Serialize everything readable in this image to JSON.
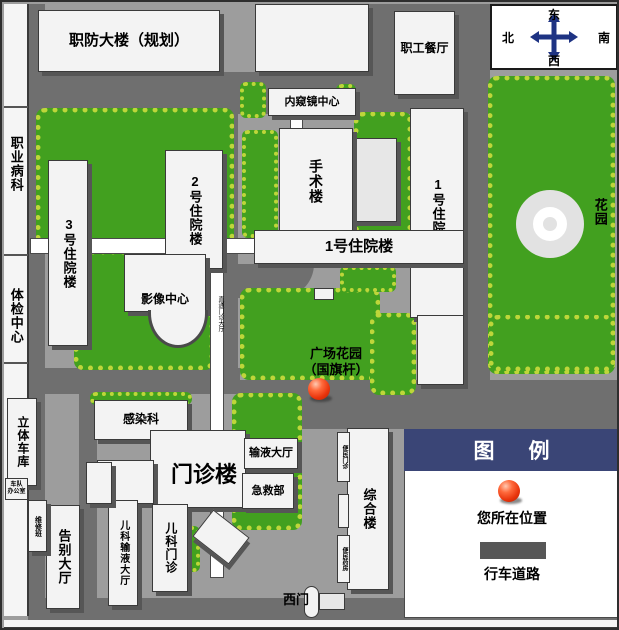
{
  "b": {
    "zhifang": "职防大楼（规划）",
    "canting": "职工餐厅",
    "neikuijing": "内窥镜中心",
    "shoushu": "手术楼",
    "zhuyuan1_tower": "1号住院楼",
    "zhuyuan1_wing": "1号住院楼",
    "zhuyuan2": "2号住院楼",
    "zhuyuan3": "3号住院楼",
    "yingxiang": "影像中心",
    "huayuan": "花园",
    "plaza_line1": "广场花园",
    "plaza_line2": "（国旗杆）",
    "ganran": "感染科",
    "menzhen": "门诊楼",
    "shuye": "输液大厅",
    "jijiu": "急救部",
    "erke_menzhen": "儿科门诊",
    "erke_shuye": "儿科输液大厅",
    "gaobie": "告别大厅",
    "weixiu": "维修班",
    "liti": "立体车库",
    "chedui_line1": "车队",
    "chedui_line2": "办公室",
    "zonghe": "综合楼",
    "bianmin_menzhen": "便民门诊",
    "bianmin_yaofang": "便民药房",
    "ximen": "西门",
    "zhiye": "职业病科",
    "tijian": "体检中心",
    "corridor": "直通门诊大厅"
  },
  "compass": {
    "top": "东",
    "left": "北",
    "right": "南",
    "bottom": "西"
  },
  "legend": {
    "title": "图例",
    "marker_label": "您所在位置",
    "road_label": "行车道路"
  },
  "colors": {
    "background": "#9d9d9d",
    "road": "#6f6f6f",
    "lawn": "#42a01f",
    "tree": "#bed63a",
    "building": "#f3f3f3",
    "legend_header": "#3a4576",
    "marker_red": "#e8330b",
    "compass_arrow": "#1e3383"
  }
}
